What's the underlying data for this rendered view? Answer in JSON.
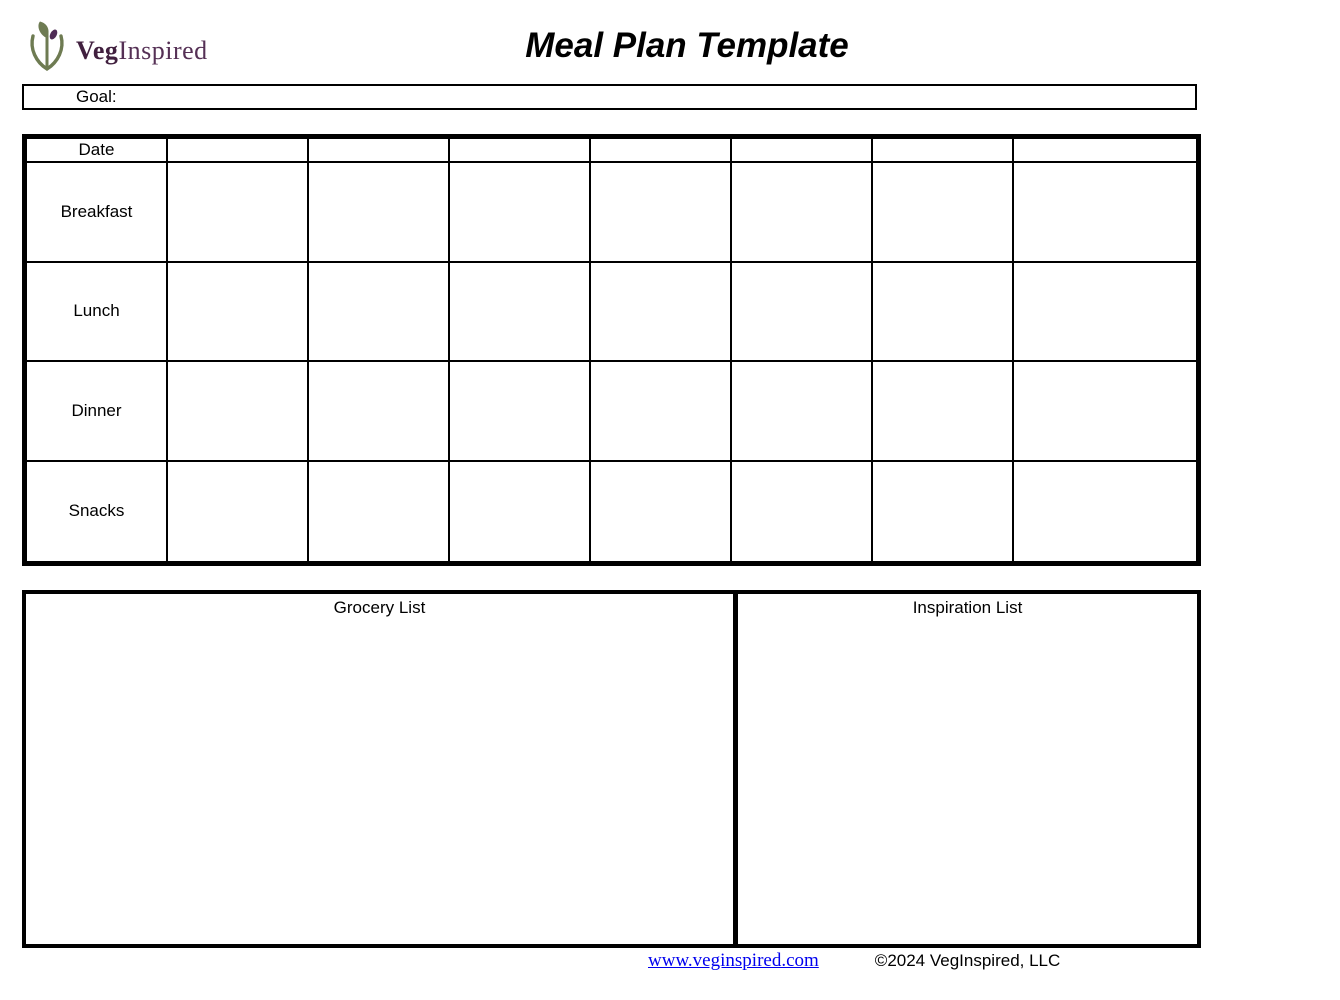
{
  "logo": {
    "brand_bold": "Veg",
    "brand_regular": "Inspired",
    "icon": "sprout-leaf-icon",
    "colors": {
      "green": "#6e7b52",
      "purple": "#4f2b56"
    }
  },
  "title": "Meal Plan Template",
  "goal": {
    "label": "Goal:"
  },
  "meal_table": {
    "header_label": "Date",
    "day_columns": 7,
    "rows": [
      {
        "label": "Breakfast"
      },
      {
        "label": "Lunch"
      },
      {
        "label": "Dinner"
      },
      {
        "label": "Snacks"
      }
    ]
  },
  "lists": {
    "grocery_title": "Grocery List",
    "inspiration_title": "Inspiration List"
  },
  "footer": {
    "link": "www.veginspired.com",
    "copyright": "©2024 VegInspired, LLC"
  }
}
